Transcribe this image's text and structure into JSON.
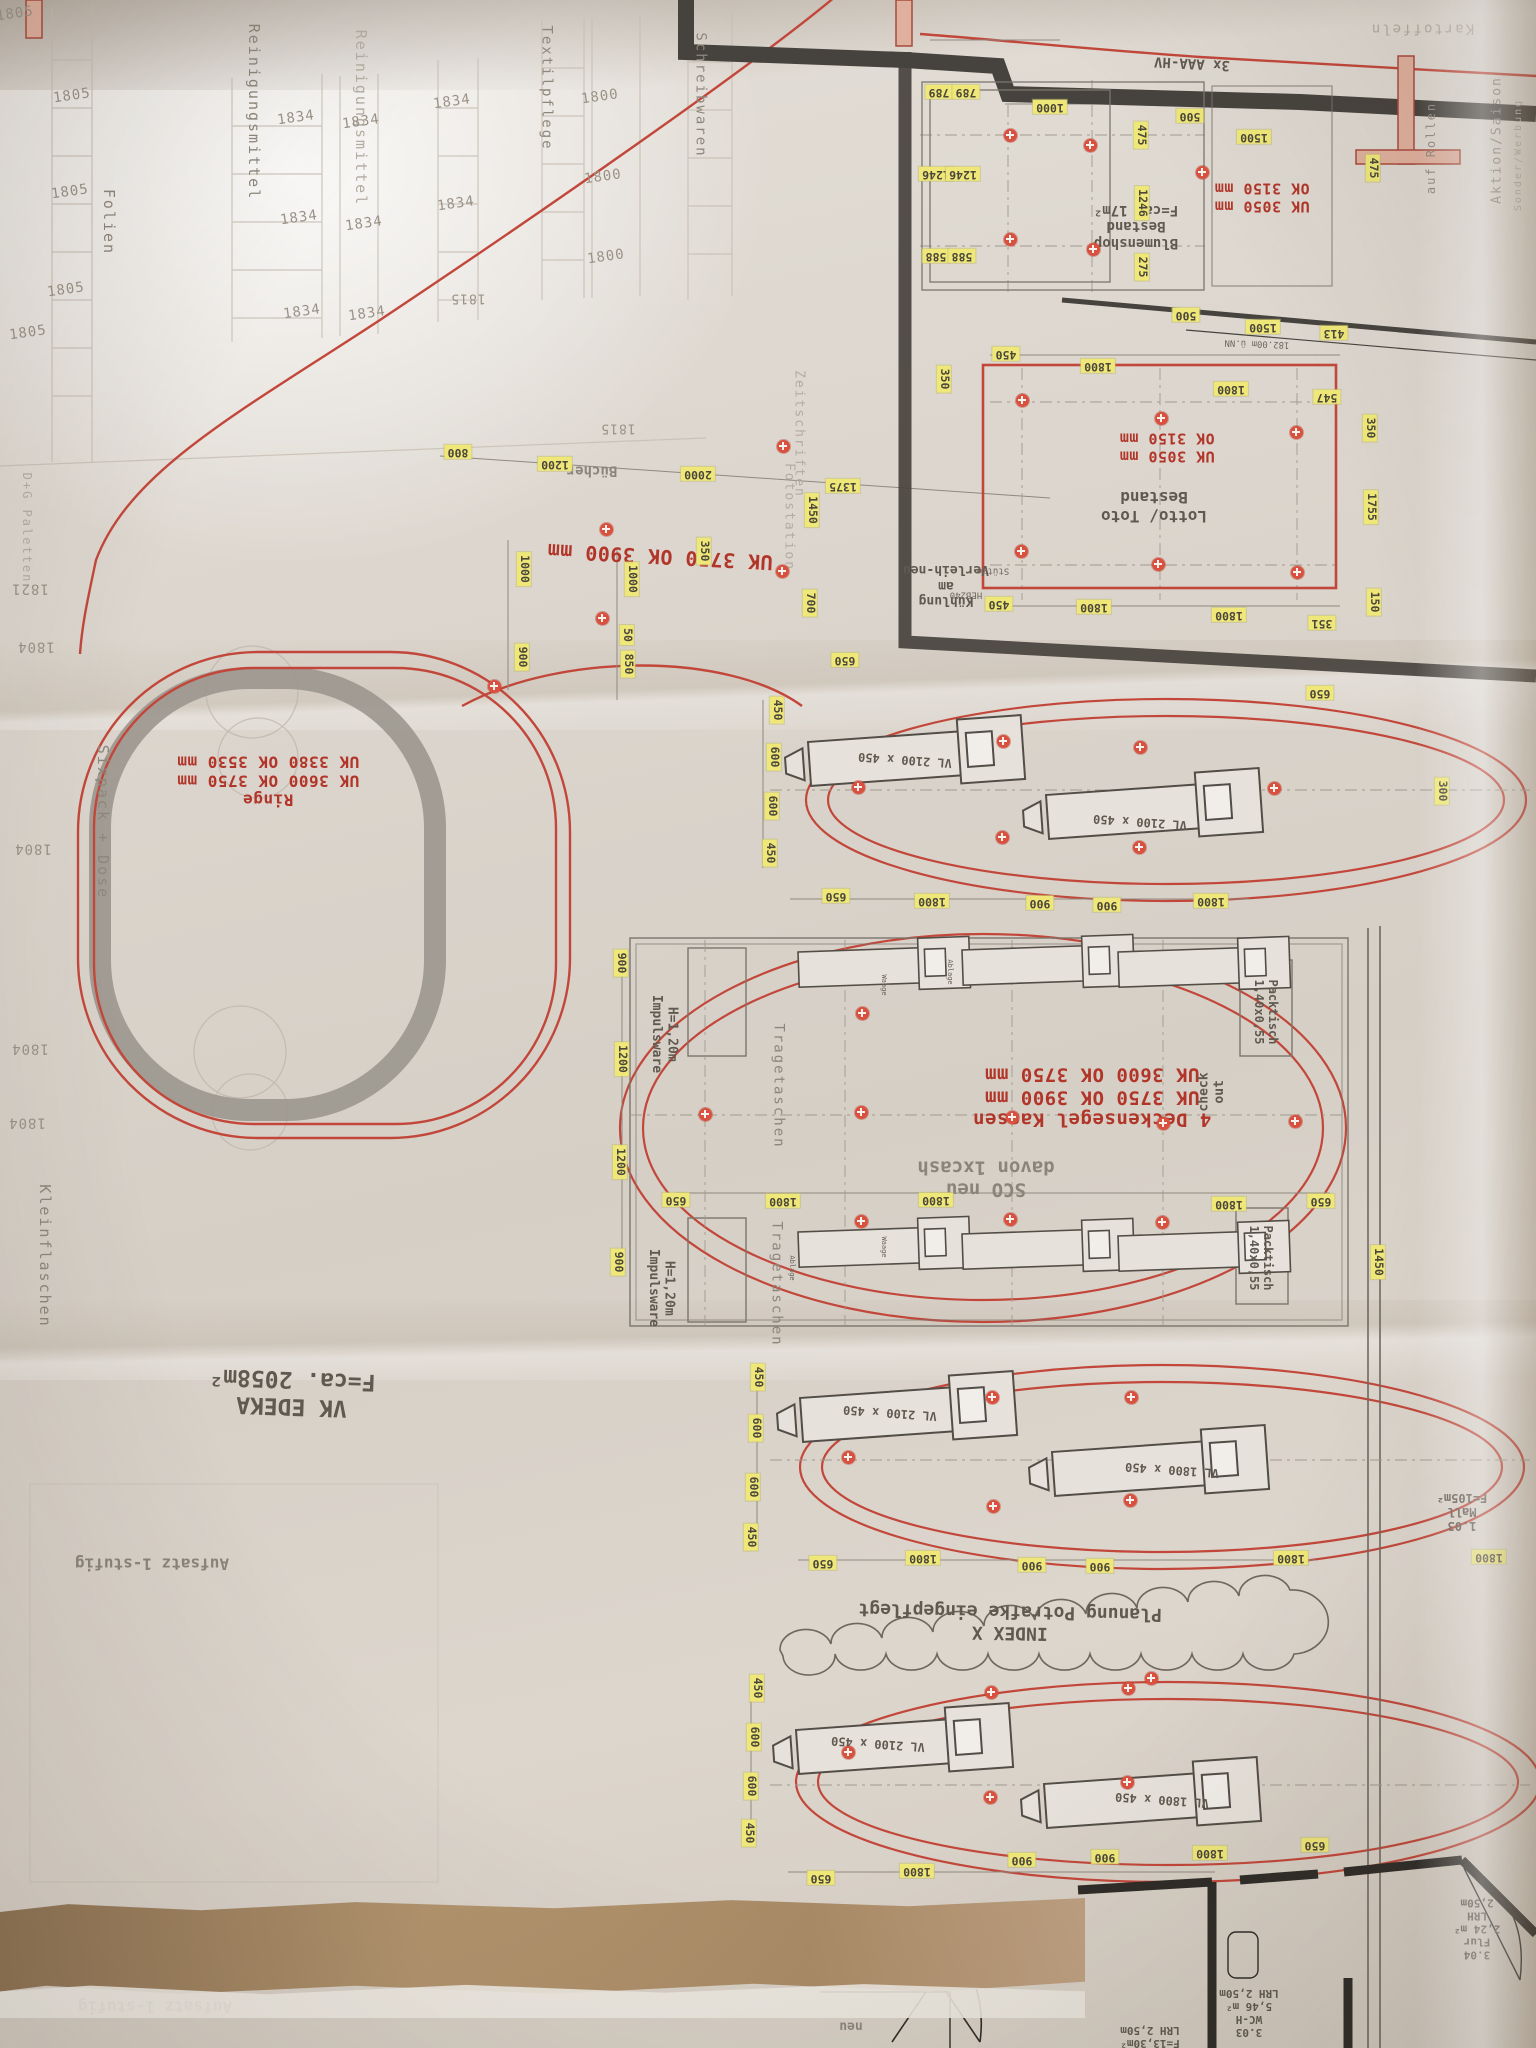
{
  "document": {
    "type": "supermarket-floor-plan-photo",
    "orientation_note": "plan photographed rotated 180°"
  },
  "palette": {
    "paper": "#ddd7cf",
    "red_ink": "#b23529",
    "highlight_yellow": "#efe878",
    "wall_dark": "#46423d",
    "line_gray": "#7b766e",
    "fold_tan": "#a98a66"
  },
  "key_notes": {
    "sales_area": "VK EDEKA\nF=ca. 2058m²",
    "revision": "INDEX X\nPlanung Potrafke eingepflegt",
    "ceiling_sails": "4 Deckensegel Kassen\nUK 3750 OK 3900 mm\nUK 3600 OK 3750 mm",
    "sco": "SCO neu\ndavon 1xcash",
    "rings": "Ringe\nUK 3600 OK 3750 mm\nUK 3380 OK 3530 mm",
    "aisle_height": "UK 3750 OK 3900 mm",
    "lotto": "Lotto/ Toto\nBestand",
    "blumenshop": "Blumenshop\nBestand\nF=ca. 17m²",
    "heights_bestand": "UK 3050 mm\nOK 3150 mm",
    "mall": "1.03\nMall\nF=105m²"
  },
  "labels": [
    {
      "n": "height-note-blumenshop",
      "t": "UK 3050 mm\nOK 3150 mm",
      "x": 1262,
      "y": 197,
      "r": 180,
      "c": "red",
      "s": 15
    },
    {
      "n": "height-note-lotto",
      "t": "UK 3050 mm\nOK 3150 mm",
      "x": 1167,
      "y": 447,
      "r": 180,
      "c": "red",
      "s": 15
    },
    {
      "n": "height-note-aisle",
      "t": "UK 3750 OK 3900 mm",
      "x": 660,
      "y": 556,
      "r": 183,
      "c": "red",
      "s": 20
    },
    {
      "n": "rings-note",
      "t": "Ringe\nUK 3600 OK 3750 mm\nUK 3380 OK 3530 mm",
      "x": 268,
      "y": 780,
      "r": 180,
      "c": "red",
      "s": 16
    },
    {
      "n": "ceiling-sail-note",
      "t": "4 Deckensegel Kassen\nUK 3750 OK 3900 mm\nUK 3600 OK 3750 mm",
      "x": 1092,
      "y": 1097,
      "r": 180,
      "c": "red",
      "s": 19
    },
    {
      "n": "blumenshop-label",
      "t": "Blumenshop\nBestand\nF=ca. 17m²",
      "x": 1136,
      "y": 226,
      "r": 180,
      "c": "gray",
      "s": 14
    },
    {
      "n": "lotto-label",
      "t": "Lotto/ Toto\nBestand",
      "x": 1154,
      "y": 506,
      "r": 180,
      "c": "gray",
      "s": 16
    },
    {
      "n": "sco-label",
      "t": "SCO neu\ndavon 1xcash",
      "x": 986,
      "y": 1178,
      "r": 180,
      "c": "grayl",
      "s": 19
    },
    {
      "n": "sales-area-label",
      "t": "VK EDEKA\nF=ca. 2058m²",
      "x": 292,
      "y": 1392,
      "r": 182,
      "c": "gray",
      "s": 23
    },
    {
      "n": "revision-cloud-label",
      "t": "INDEX X\nPlanung Potrafke eingepflegt",
      "x": 1010,
      "y": 1622,
      "r": 181,
      "c": "gray",
      "s": 18
    },
    {
      "n": "mall-label",
      "t": "1.03\nMall\nF=105m²",
      "x": 1462,
      "y": 1512,
      "r": 180,
      "c": "gray",
      "s": 12
    },
    {
      "n": "room-flur",
      "t": "3.04\nFlur\n2,24 m²\nLRH 2,50m",
      "x": 1477,
      "y": 1928,
      "r": 180,
      "c": "gray",
      "s": 11
    },
    {
      "n": "room-wc",
      "t": "3.03\nWC-H\n5,46 m²\nLRH 2,50m",
      "x": 1249,
      "y": 2012,
      "r": 180,
      "c": "gray",
      "s": 11
    },
    {
      "n": "room-area",
      "t": "F=13,30m²\nLRH 2,50m",
      "x": 1150,
      "y": 2036,
      "r": 180,
      "c": "gray",
      "s": 11
    },
    {
      "n": "neu-label",
      "t": "neu",
      "x": 851,
      "y": 2026,
      "r": 180,
      "c": "grayl",
      "s": 13
    },
    {
      "n": "kuehlung-label",
      "t": "Kühlung\nam\nVerleih-neu",
      "x": 946,
      "y": 585,
      "r": 180,
      "c": "gray",
      "s": 13
    },
    {
      "n": "stuetze-label",
      "t": "Stütze",
      "x": 993,
      "y": 570,
      "r": 180,
      "c": "tiny",
      "s": 9
    },
    {
      "n": "beam-label",
      "t": "HEB240",
      "x": 966,
      "y": 594,
      "r": 180,
      "c": "tiny",
      "s": 9
    },
    {
      "n": "level-label",
      "t": "182.00m ü.NN",
      "x": 1257,
      "y": 343,
      "r": 182,
      "c": "tiny",
      "s": 9
    },
    {
      "n": "buecher-label",
      "t": "Bücher",
      "x": 592,
      "y": 470,
      "r": 180,
      "c": "grayl",
      "s": 14
    },
    {
      "n": "checkout-label",
      "t": "check\nout",
      "x": 1212,
      "y": 1092,
      "r": 180,
      "c": "gray",
      "s": 13,
      "v": 1
    },
    {
      "n": "vl-label",
      "t": "VL 2100 x 450",
      "x": 905,
      "y": 760,
      "r": 184,
      "c": "gray",
      "s": 12
    },
    {
      "n": "vl-label",
      "t": "VL 2100 x 450",
      "x": 1140,
      "y": 822,
      "r": 184,
      "c": "gray",
      "s": 12
    },
    {
      "n": "vl-label",
      "t": "VL 2100 x 450",
      "x": 890,
      "y": 1413,
      "r": 184,
      "c": "gray",
      "s": 12
    },
    {
      "n": "vl-label",
      "t": "VL 1800 x 450",
      "x": 1172,
      "y": 1470,
      "r": 184,
      "c": "gray",
      "s": 12
    },
    {
      "n": "vl-label",
      "t": "VL 2100 x 450",
      "x": 878,
      "y": 1744,
      "r": 184,
      "c": "gray",
      "s": 12
    },
    {
      "n": "vl-label",
      "t": "VL 1800 x 450",
      "x": 1162,
      "y": 1800,
      "r": 184,
      "c": "gray",
      "s": 12
    },
    {
      "n": "dept-folien",
      "t": "Folien",
      "x": 108,
      "y": 222,
      "r": 0,
      "c": "dept",
      "s": 15,
      "v": 1
    },
    {
      "n": "dept-reinigung",
      "t": "Reinigungsmittel",
      "x": 253,
      "y": 112,
      "r": 0,
      "c": "dept",
      "s": 15,
      "v": 1
    },
    {
      "n": "dept-reinigung",
      "t": "Reinigungsmittel",
      "x": 360,
      "y": 118,
      "r": 0,
      "c": "deptl",
      "s": 15,
      "v": 1
    },
    {
      "n": "dept-textil",
      "t": "Textilpflege",
      "x": 546,
      "y": 88,
      "r": 0,
      "c": "dept",
      "s": 14,
      "v": 1
    },
    {
      "n": "dept-schreibwaren",
      "t": "Schreibwaren",
      "x": 700,
      "y": 95,
      "r": 0,
      "c": "dept",
      "s": 14,
      "v": 1
    },
    {
      "n": "dept-zeitschriften",
      "t": "Zeitschriften",
      "x": 799,
      "y": 434,
      "r": 0,
      "c": "deptl",
      "s": 13,
      "v": 1
    },
    {
      "n": "dept-fotostation",
      "t": "Fotostation",
      "x": 789,
      "y": 517,
      "r": 0,
      "c": "deptl",
      "s": 13,
      "v": 1
    },
    {
      "n": "dept-tragetaschen",
      "t": "Tragetaschen",
      "x": 778,
      "y": 1086,
      "r": 0,
      "c": "dept",
      "s": 14,
      "v": 1
    },
    {
      "n": "dept-tragetaschen",
      "t": "Tragetaschen",
      "x": 776,
      "y": 1284,
      "r": 0,
      "c": "dept",
      "s": 14,
      "v": 1
    },
    {
      "n": "impulsware-label",
      "t": "H=1,20m\nImpulsware",
      "x": 664,
      "y": 1034,
      "r": 0,
      "c": "gray",
      "s": 13,
      "v": 1
    },
    {
      "n": "impulsware-label",
      "t": "H=1,20m\nImpulsware",
      "x": 661,
      "y": 1288,
      "r": 0,
      "c": "gray",
      "s": 13,
      "v": 1
    },
    {
      "n": "packtisch-label",
      "t": "Packtisch\n1,40x0,55",
      "x": 1266,
      "y": 1012,
      "r": 0,
      "c": "gray",
      "s": 12,
      "v": 1
    },
    {
      "n": "packtisch-label",
      "t": "Packtisch\n1,40x0,55",
      "x": 1261,
      "y": 1258,
      "r": 0,
      "c": "gray",
      "s": 12,
      "v": 1
    },
    {
      "n": "dept-sixpack",
      "t": "Sixpack + Dose",
      "x": 102,
      "y": 822,
      "r": 0,
      "c": "dept",
      "s": 15,
      "v": 1
    },
    {
      "n": "dept-kleinflaschen",
      "t": "Kleinflaschen",
      "x": 44,
      "y": 1256,
      "r": 0,
      "c": "dept",
      "s": 15,
      "v": 1
    },
    {
      "n": "dept-paletten",
      "t": "D+G Paletten",
      "x": 27,
      "y": 528,
      "r": 0,
      "c": "deptl",
      "s": 12,
      "v": 1
    },
    {
      "n": "aktion-saison-label",
      "t": "Aktion/Saison",
      "x": 1497,
      "y": 140,
      "r": 180,
      "c": "dept",
      "s": 13,
      "v": 1
    },
    {
      "n": "sonder-werbung-label",
      "t": "Sonder/Werbung",
      "x": 1519,
      "y": 155,
      "r": 180,
      "c": "deptl",
      "s": 10,
      "v": 1
    },
    {
      "n": "auf-rollen-label",
      "t": "auf Rollen",
      "x": 1431,
      "y": 148,
      "r": 180,
      "c": "dept",
      "s": 12,
      "v": 1
    },
    {
      "n": "kartoffeln-label",
      "t": "Kartoffeln",
      "x": 1422,
      "y": 28,
      "r": 180,
      "c": "deptl",
      "s": 14
    },
    {
      "n": "aaa-hv-label",
      "t": "3x AAA-HV",
      "x": 1192,
      "y": 63,
      "r": 183,
      "c": "gray",
      "s": 14
    },
    {
      "n": "waage-label",
      "t": "Waage",
      "x": 884,
      "y": 985,
      "r": 0,
      "c": "tiny",
      "s": 7,
      "v": 1
    },
    {
      "n": "ablage-label",
      "t": "Ablage",
      "x": 950,
      "y": 972,
      "r": 0,
      "c": "tiny",
      "s": 7,
      "v": 1
    },
    {
      "n": "waage-label",
      "t": "Waage",
      "x": 884,
      "y": 1247,
      "r": 0,
      "c": "tiny",
      "s": 7,
      "v": 1
    },
    {
      "n": "ablage-label",
      "t": "Ablage",
      "x": 792,
      "y": 1268,
      "r": 0,
      "c": "tiny",
      "s": 7,
      "v": 1
    },
    {
      "n": "aufsatz-label",
      "t": "Aufsatz 1-stufig",
      "x": 152,
      "y": 1563,
      "r": 180,
      "c": "grayl",
      "s": 16
    },
    {
      "n": "aufsatz-label",
      "t": "Aufsatz 1-stufig",
      "x": 155,
      "y": 2006,
      "r": 180,
      "c": "grayl",
      "s": 16
    },
    {
      "n": "shelf-code",
      "t": "1805",
      "x": 72,
      "y": 96,
      "r": -8,
      "c": "code",
      "s": 14
    },
    {
      "n": "shelf-code",
      "t": "1805",
      "x": 70,
      "y": 192,
      "r": -8,
      "c": "code",
      "s": 14
    },
    {
      "n": "shelf-code",
      "t": "1805",
      "x": 66,
      "y": 290,
      "r": -8,
      "c": "code",
      "s": 14
    },
    {
      "n": "shelf-code",
      "t": "1805",
      "x": 28,
      "y": 333,
      "r": -8,
      "c": "code",
      "s": 14
    },
    {
      "n": "shelf-code",
      "t": "1805",
      "x": 15,
      "y": 14,
      "r": -8,
      "c": "code",
      "s": 14
    },
    {
      "n": "shelf-code",
      "t": "1834",
      "x": 296,
      "y": 118,
      "r": -8,
      "c": "code",
      "s": 14
    },
    {
      "n": "shelf-code",
      "t": "1834",
      "x": 299,
      "y": 218,
      "r": -8,
      "c": "code",
      "s": 14
    },
    {
      "n": "shelf-code",
      "t": "1834",
      "x": 302,
      "y": 312,
      "r": -8,
      "c": "code",
      "s": 14
    },
    {
      "n": "shelf-code",
      "t": "1834",
      "x": 361,
      "y": 122,
      "r": -8,
      "c": "code",
      "s": 14
    },
    {
      "n": "shelf-code",
      "t": "1834",
      "x": 364,
      "y": 224,
      "r": -8,
      "c": "code",
      "s": 14
    },
    {
      "n": "shelf-code",
      "t": "1834",
      "x": 367,
      "y": 314,
      "r": -8,
      "c": "code",
      "s": 14
    },
    {
      "n": "shelf-code",
      "t": "1834",
      "x": 452,
      "y": 102,
      "r": -8,
      "c": "code",
      "s": 14
    },
    {
      "n": "shelf-code",
      "t": "1834",
      "x": 456,
      "y": 204,
      "r": -8,
      "c": "code",
      "s": 14
    },
    {
      "n": "shelf-code",
      "t": "1800",
      "x": 600,
      "y": 97,
      "r": -8,
      "c": "code",
      "s": 14
    },
    {
      "n": "shelf-code",
      "t": "1800",
      "x": 603,
      "y": 177,
      "r": -8,
      "c": "code",
      "s": 14
    },
    {
      "n": "shelf-code",
      "t": "1800",
      "x": 606,
      "y": 257,
      "r": -8,
      "c": "code",
      "s": 14
    },
    {
      "n": "shelf-code",
      "t": "1815",
      "x": 468,
      "y": 298,
      "r": 180,
      "c": "code",
      "s": 13
    },
    {
      "n": "shelf-code",
      "t": "1815",
      "x": 618,
      "y": 428,
      "r": 180,
      "c": "code",
      "s": 13
    },
    {
      "n": "shelf-code",
      "t": "1821",
      "x": 30,
      "y": 588,
      "r": 180,
      "c": "code",
      "s": 14
    },
    {
      "n": "shelf-code",
      "t": "1804",
      "x": 36,
      "y": 646,
      "r": 180,
      "c": "code",
      "s": 14
    },
    {
      "n": "shelf-code",
      "t": "1804",
      "x": 33,
      "y": 848,
      "r": 180,
      "c": "code",
      "s": 14
    },
    {
      "n": "shelf-code",
      "t": "1804",
      "x": 30,
      "y": 1048,
      "r": 180,
      "c": "code",
      "s": 14
    },
    {
      "n": "shelf-code",
      "t": "1804",
      "x": 27,
      "y": 1122,
      "r": 180,
      "c": "code",
      "s": 14
    }
  ],
  "dims": [
    {
      "t": "789",
      "x": 939,
      "y": 92
    },
    {
      "t": "789",
      "x": 966,
      "y": 92
    },
    {
      "t": "1000",
      "x": 1050,
      "y": 107
    },
    {
      "t": "1246",
      "x": 936,
      "y": 174
    },
    {
      "t": "1246",
      "x": 963,
      "y": 174
    },
    {
      "t": "588",
      "x": 936,
      "y": 256
    },
    {
      "t": "588",
      "x": 962,
      "y": 256
    },
    {
      "t": "500",
      "x": 1190,
      "y": 116
    },
    {
      "t": "1500",
      "x": 1254,
      "y": 137
    },
    {
      "t": "450",
      "x": 1006,
      "y": 354
    },
    {
      "t": "1800",
      "x": 1098,
      "y": 366
    },
    {
      "t": "1800",
      "x": 1231,
      "y": 389
    },
    {
      "t": "547",
      "x": 1327,
      "y": 397
    },
    {
      "t": "413",
      "x": 1334,
      "y": 333
    },
    {
      "t": "1500",
      "x": 1263,
      "y": 327
    },
    {
      "t": "500",
      "x": 1186,
      "y": 315
    },
    {
      "t": "450",
      "x": 999,
      "y": 604
    },
    {
      "t": "1800",
      "x": 1094,
      "y": 607
    },
    {
      "t": "1800",
      "x": 1229,
      "y": 615
    },
    {
      "t": "351",
      "x": 1322,
      "y": 623
    },
    {
      "t": "800",
      "x": 458,
      "y": 452
    },
    {
      "t": "1200",
      "x": 555,
      "y": 464
    },
    {
      "t": "2000",
      "x": 698,
      "y": 474
    },
    {
      "t": "1375",
      "x": 843,
      "y": 486
    },
    {
      "t": "650",
      "x": 845,
      "y": 660
    },
    {
      "t": "650",
      "x": 836,
      "y": 896
    },
    {
      "t": "1800",
      "x": 932,
      "y": 901
    },
    {
      "t": "900",
      "x": 1040,
      "y": 903
    },
    {
      "t": "900",
      "x": 1107,
      "y": 905
    },
    {
      "t": "1800",
      "x": 1211,
      "y": 901
    },
    {
      "t": "650",
      "x": 1320,
      "y": 693
    },
    {
      "t": "650",
      "x": 676,
      "y": 1200
    },
    {
      "t": "1800",
      "x": 783,
      "y": 1201
    },
    {
      "t": "1800",
      "x": 936,
      "y": 1200
    },
    {
      "t": "1800",
      "x": 1229,
      "y": 1204
    },
    {
      "t": "650",
      "x": 1321,
      "y": 1201
    },
    {
      "t": "650",
      "x": 823,
      "y": 1563
    },
    {
      "t": "1800",
      "x": 923,
      "y": 1558
    },
    {
      "t": "900",
      "x": 1032,
      "y": 1565
    },
    {
      "t": "900",
      "x": 1100,
      "y": 1566
    },
    {
      "t": "1800",
      "x": 1291,
      "y": 1558
    },
    {
      "t": "1800",
      "x": 1489,
      "y": 1557
    },
    {
      "t": "650",
      "x": 821,
      "y": 1878
    },
    {
      "t": "1800",
      "x": 917,
      "y": 1871
    },
    {
      "t": "900",
      "x": 1022,
      "y": 1860
    },
    {
      "t": "900",
      "x": 1105,
      "y": 1857
    },
    {
      "t": "1800",
      "x": 1210,
      "y": 1853
    },
    {
      "t": "650",
      "x": 1315,
      "y": 1845
    }
  ],
  "dims_vertical": [
    {
      "t": "475",
      "x": 1141,
      "y": 135
    },
    {
      "t": "1246",
      "x": 1142,
      "y": 203
    },
    {
      "t": "275",
      "x": 1142,
      "y": 267
    },
    {
      "t": "475",
      "x": 1373,
      "y": 168
    },
    {
      "t": "350",
      "x": 944,
      "y": 379
    },
    {
      "t": "350",
      "x": 1370,
      "y": 428
    },
    {
      "t": "1755",
      "x": 1371,
      "y": 507
    },
    {
      "t": "150",
      "x": 1374,
      "y": 602
    },
    {
      "t": "1450",
      "x": 812,
      "y": 510
    },
    {
      "t": "1000",
      "x": 524,
      "y": 569
    },
    {
      "t": "1000",
      "x": 632,
      "y": 579
    },
    {
      "t": "350",
      "x": 704,
      "y": 551
    },
    {
      "t": "900",
      "x": 522,
      "y": 657
    },
    {
      "t": "850",
      "x": 628,
      "y": 664
    },
    {
      "t": "50",
      "x": 627,
      "y": 635
    },
    {
      "t": "700",
      "x": 810,
      "y": 603
    },
    {
      "t": "450",
      "x": 777,
      "y": 710
    },
    {
      "t": "600",
      "x": 774,
      "y": 757
    },
    {
      "t": "600",
      "x": 772,
      "y": 806
    },
    {
      "t": "450",
      "x": 770,
      "y": 853
    },
    {
      "t": "300",
      "x": 1442,
      "y": 791
    },
    {
      "t": "900",
      "x": 621,
      "y": 963
    },
    {
      "t": "1200",
      "x": 622,
      "y": 1059
    },
    {
      "t": "1200",
      "x": 620,
      "y": 1162
    },
    {
      "t": "900",
      "x": 618,
      "y": 1262
    },
    {
      "t": "1450",
      "x": 1378,
      "y": 1262
    },
    {
      "t": "450",
      "x": 758,
      "y": 1377
    },
    {
      "t": "600",
      "x": 756,
      "y": 1428
    },
    {
      "t": "600",
      "x": 753,
      "y": 1487
    },
    {
      "t": "450",
      "x": 751,
      "y": 1537
    },
    {
      "t": "450",
      "x": 757,
      "y": 1688
    },
    {
      "t": "600",
      "x": 754,
      "y": 1737
    },
    {
      "t": "600",
      "x": 751,
      "y": 1786
    },
    {
      "t": "450",
      "x": 749,
      "y": 1833
    }
  ],
  "sprinkler_dots": [
    [
      1010,
      135
    ],
    [
      1090,
      145
    ],
    [
      1010,
      239
    ],
    [
      1093,
      249
    ],
    [
      1202,
      172
    ],
    [
      1022,
      400
    ],
    [
      1161,
      418
    ],
    [
      1296,
      432
    ],
    [
      1021,
      551
    ],
    [
      1158,
      564
    ],
    [
      1297,
      572
    ],
    [
      606,
      529
    ],
    [
      602,
      618
    ],
    [
      783,
      446
    ],
    [
      782,
      571
    ],
    [
      494,
      686
    ],
    [
      858,
      787
    ],
    [
      1003,
      741
    ],
    [
      1140,
      747
    ],
    [
      1002,
      837
    ],
    [
      1139,
      847
    ],
    [
      1274,
      788
    ],
    [
      705,
      1114
    ],
    [
      861,
      1112
    ],
    [
      862,
      1013
    ],
    [
      861,
      1221
    ],
    [
      1012,
      1117
    ],
    [
      1163,
      1123
    ],
    [
      1010,
      1219
    ],
    [
      1162,
      1222
    ],
    [
      1295,
      1121
    ],
    [
      1151,
      1678
    ],
    [
      848,
      1457
    ],
    [
      992,
      1397
    ],
    [
      1131,
      1397
    ],
    [
      993,
      1506
    ],
    [
      1130,
      1500
    ],
    [
      848,
      1752
    ],
    [
      991,
      1692
    ],
    [
      1128,
      1688
    ],
    [
      990,
      1797
    ],
    [
      1127,
      1782
    ]
  ]
}
